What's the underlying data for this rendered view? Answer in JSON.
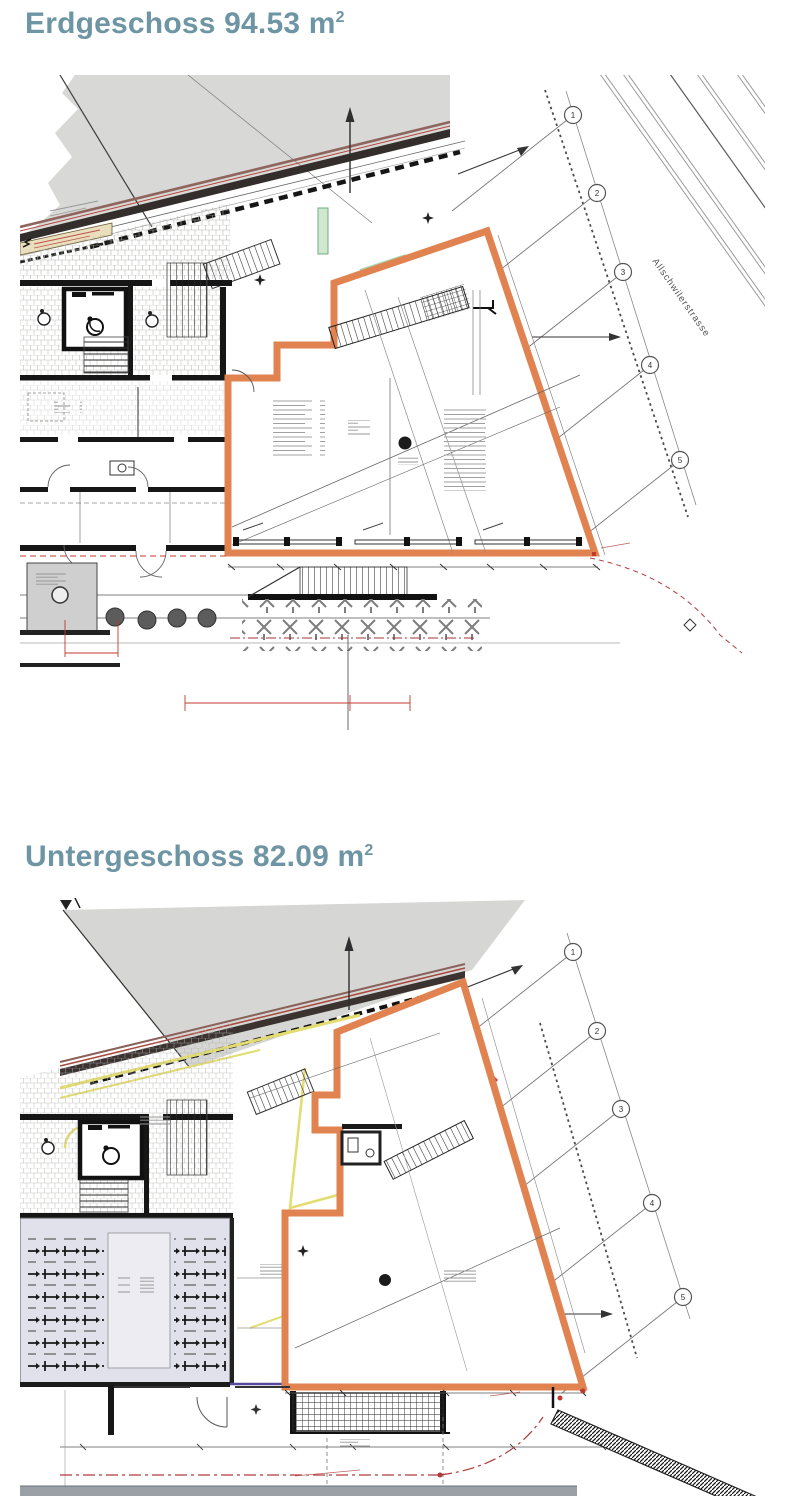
{
  "page": {
    "background_color": "#ffffff"
  },
  "sections": [
    {
      "title": "Erdgeschoss",
      "area": "94.53",
      "unit": "m",
      "exponent": "2"
    },
    {
      "title": "Untergeschoss",
      "area": "82.09",
      "unit": "m",
      "exponent": "2"
    }
  ],
  "plan1": {
    "street_label": "Allschwilerstrasse",
    "axes": [
      "1",
      "2",
      "3",
      "4",
      "5"
    ]
  },
  "plan2": {
    "axes": [
      "1",
      "2",
      "3",
      "4",
      "5"
    ]
  },
  "colors": {
    "heading": "#6e95a3",
    "unit_outline": "#e08350",
    "demolition_yellow": "#e3dc6e",
    "marking_red": "#c0392b",
    "neighbor_gray": "#d8d9d6"
  }
}
